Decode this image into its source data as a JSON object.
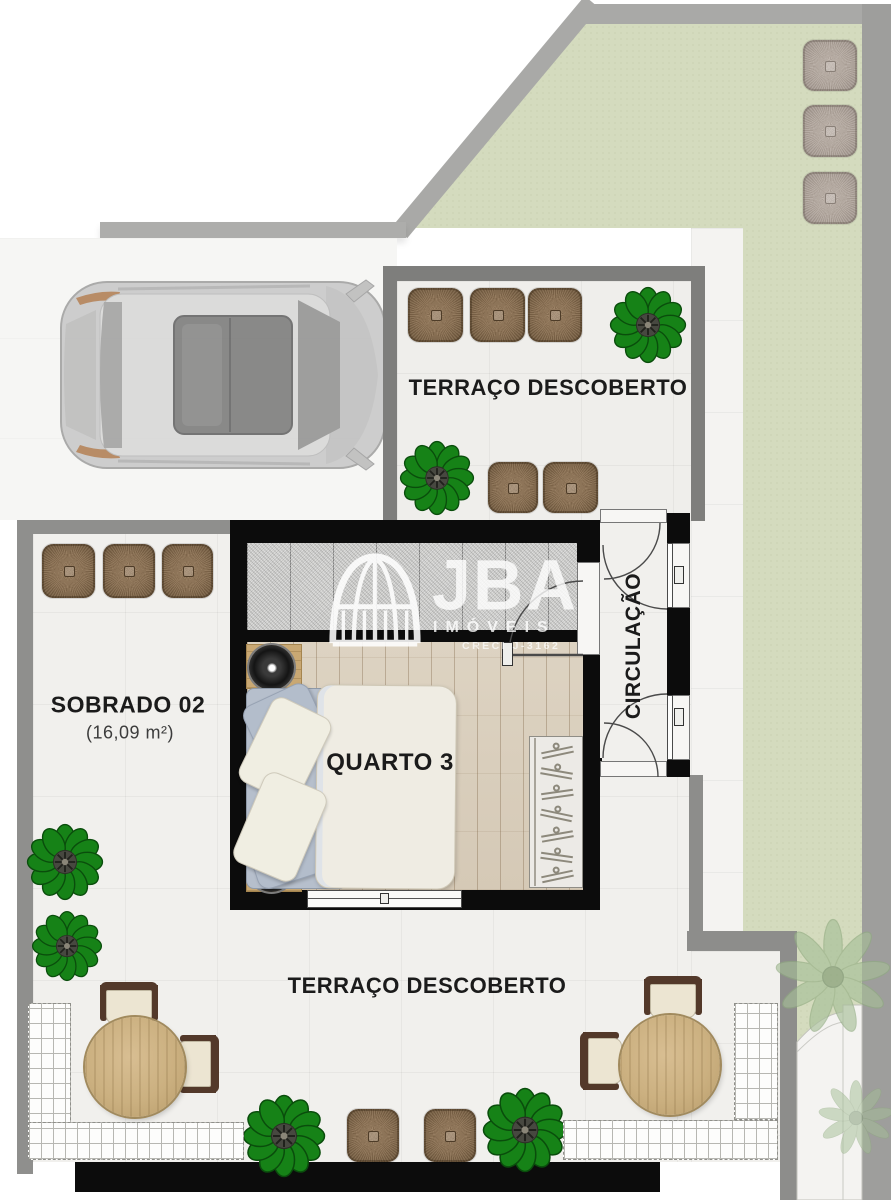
{
  "plan": {
    "labels": {
      "terrace_top": "TERRAÇO DESCOBERTO",
      "terrace_bottom": "TERRAÇO DESCOBERTO",
      "bedroom": "QUARTO 3",
      "circulation": "CIRCULAÇÃO",
      "unit": "SOBRADO 02",
      "unit_area": "(16,09 m²)"
    },
    "watermark": {
      "brand": "JBA",
      "type": "IMÓVEIS",
      "license": "CRECI J-3162"
    },
    "colors": {
      "lawn_green": "#d4dbbe",
      "wall_gray": "#8f8f8d",
      "structure_black": "#0c0c0c",
      "marble_white": "#f1f0ed",
      "wood_floor": "#d9cec0",
      "cushion_brown": "#8b7154",
      "plant_green": "#168217",
      "table_wood": "#cdb183"
    }
  }
}
